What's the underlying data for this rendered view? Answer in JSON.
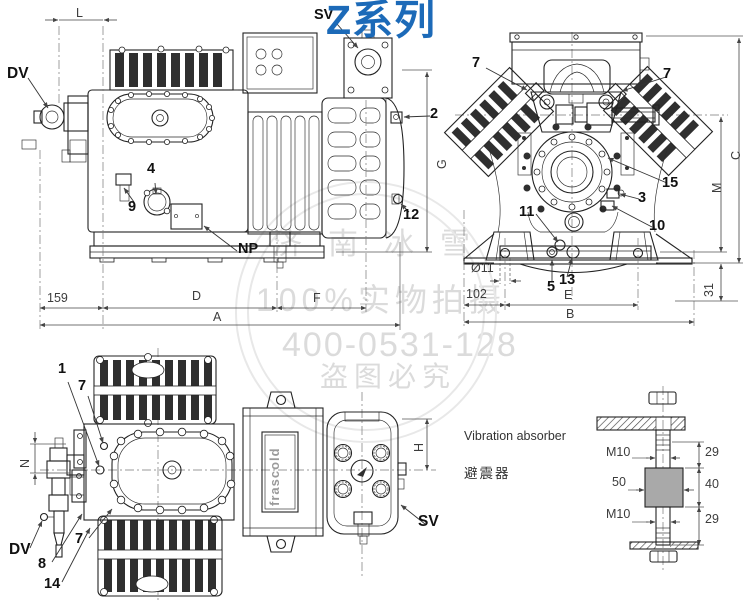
{
  "title": "Z系列",
  "brand_logo": "frascold",
  "colors": {
    "title_blue": "#1c6ab8",
    "line": "#222222",
    "watermark_gray": "#dbdbdb",
    "rubber_gray": "#a9a9a9"
  },
  "watermark": {
    "line1": "济南冰雪",
    "line2": "100%实物拍摄",
    "line3": "400-0531-128",
    "line4": "盗图必究"
  },
  "side_view": {
    "sv": "SV",
    "dv": "DV",
    "np": "NP",
    "n2": "2",
    "n4": "4",
    "n9": "9",
    "n12": "12",
    "dim_l": "L",
    "dim_159": "159",
    "dim_d": "D",
    "dim_f": "F",
    "dim_a": "A",
    "dim_g": "G"
  },
  "front_view": {
    "n7_left": "7",
    "n7_right": "7",
    "n15": "15",
    "n3": "3",
    "n10": "10",
    "n11": "11",
    "n5": "5",
    "n13": "13",
    "dim_c": "C",
    "dim_m": "M",
    "dim_31": "31",
    "dim_d11": "Ø11",
    "dim_102": "102",
    "dim_e": "E",
    "dim_b": "B"
  },
  "top_view": {
    "n1": "1",
    "n7_upper": "7",
    "n7_lower": "7",
    "n8": "8",
    "n14": "14",
    "dv": "DV",
    "sv": "SV",
    "dim_n": "N",
    "dim_h": "H"
  },
  "absorber": {
    "title_en": "Vibration absorber",
    "title_zh": "避震器",
    "thread_top": "M10",
    "thread_bottom": "M10",
    "block_width": "50",
    "dim_top": "29",
    "dim_mid": "40",
    "dim_bottom": "29"
  }
}
